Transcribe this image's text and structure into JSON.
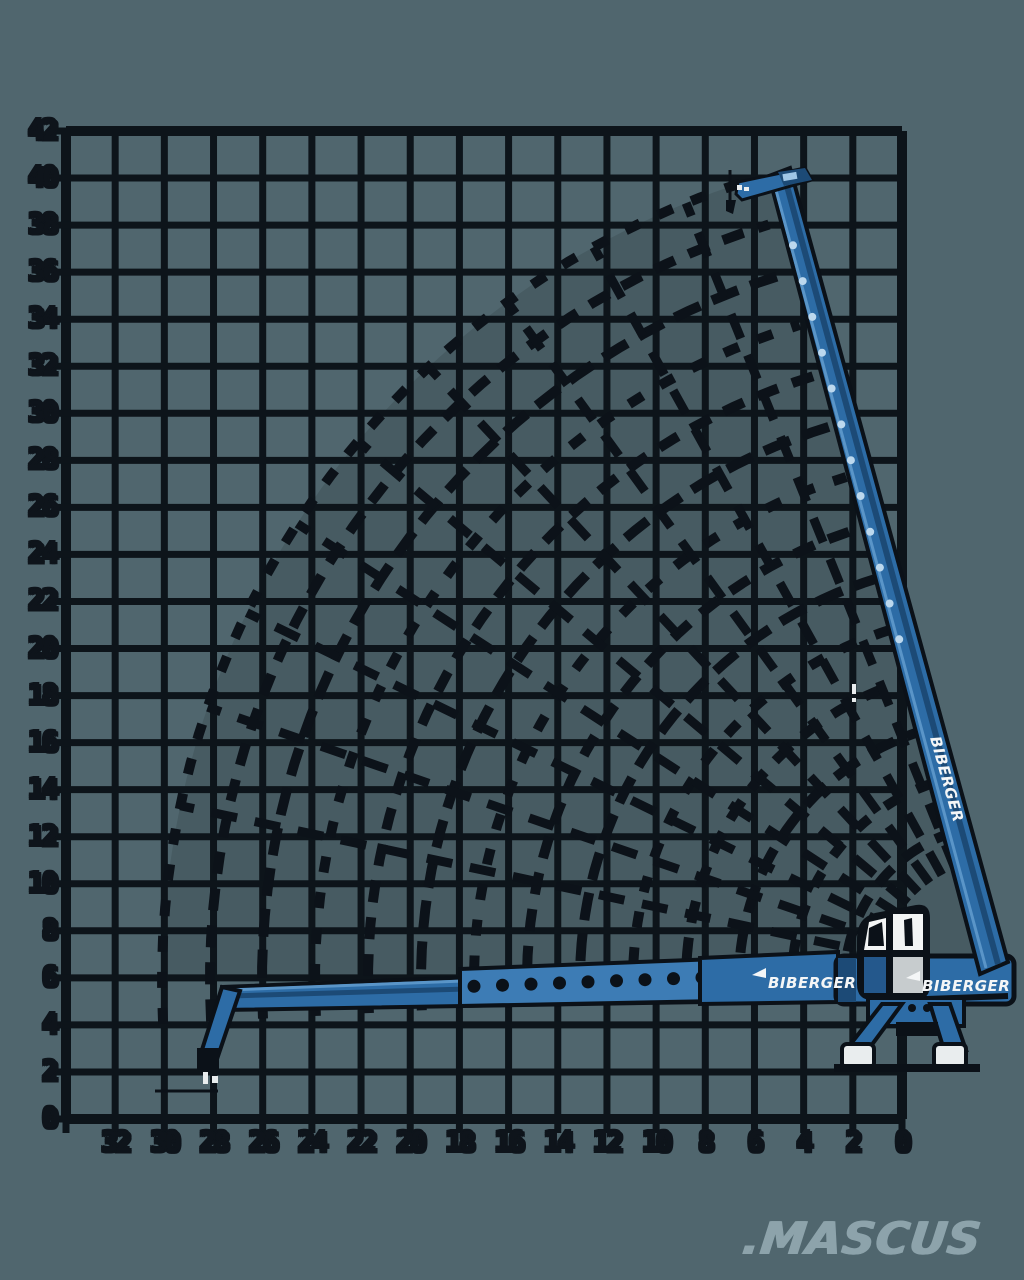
{
  "page": {
    "watermark": ".MASCUS"
  },
  "brand": {
    "name": "BIBERGER"
  },
  "colors": {
    "background": "#50666e",
    "grid_ink": "#0d141a",
    "envelope_shade": "rgba(8,14,20,0.12)",
    "crane_blue": "#2d6ca6",
    "crane_blue_dark": "#1c4a76",
    "crane_blue_light": "#5a95c8",
    "cab_glass_white": "#f3f5f5",
    "cab_pane_gray": "#c7ccce",
    "pad_white": "#e9edee",
    "watermark_gray": "#8da3ab"
  },
  "chart_data": {
    "type": "line",
    "title": "Telescopic crane working range / load radius diagram (pixelated scan)",
    "grid": true,
    "x_axis": {
      "label": "load radius (m) - digits pixelated in source, values estimated",
      "direction": "right_to_left",
      "ticks": [
        "32",
        "30",
        "28",
        "26",
        "24",
        "22",
        "20",
        "18",
        "16",
        "14",
        "12",
        "10",
        "8",
        "6",
        "4",
        "2",
        "0"
      ]
    },
    "y_axis": {
      "label": "lifting height (m) - digits pixelated in source, values estimated",
      "ticks": [
        "42",
        "40",
        "38",
        "36",
        "34",
        "32",
        "30",
        "28",
        "26",
        "24",
        "22",
        "20",
        "18",
        "16",
        "14",
        "12",
        "10",
        "8",
        "6",
        "4",
        "2",
        "0"
      ]
    },
    "envelope": {
      "pivot_px": [
        1000,
        980
      ],
      "max_boom_angle_deg": 74.4,
      "boom_angle_rays_deg": [
        12,
        19,
        26,
        33,
        40,
        47,
        54,
        61,
        68
      ],
      "reach_arc_radii_px": [
        155,
        208,
        261,
        314,
        367,
        420,
        473,
        526,
        579,
        632,
        685,
        738,
        790,
        838
      ],
      "max_reach_radius_px": 838
    },
    "machine": {
      "brand": "BIBERGER",
      "positions": [
        "boom raised ~75 deg",
        "boom horizontal at ground level"
      ]
    }
  }
}
